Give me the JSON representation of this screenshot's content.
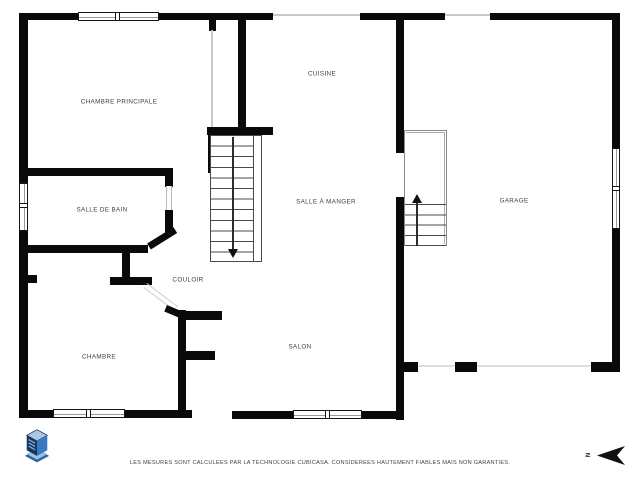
{
  "plan": {
    "type": "floor-plan",
    "rooms": [
      {
        "id": "chambre-principale",
        "label": "CHAMBRE PRINCIPALE"
      },
      {
        "id": "cuisine",
        "label": "CUISINE"
      },
      {
        "id": "salle-de-bain",
        "label": "SALLE DE BAIN"
      },
      {
        "id": "salle-a-manger",
        "label": "SALLE À MANGER"
      },
      {
        "id": "garage",
        "label": "GARAGE"
      },
      {
        "id": "couloir",
        "label": "COULOIR"
      },
      {
        "id": "chambre",
        "label": "CHAMBRE"
      },
      {
        "id": "salon",
        "label": "SALON"
      }
    ],
    "stairs": [
      {
        "id": "main-staircase",
        "direction_arrow": "down"
      },
      {
        "id": "garage-staircase",
        "direction_arrow": "up"
      }
    ],
    "window_count": 5
  },
  "footer": {
    "disclaimer": "LES MESURES SONT CALCULEES PAR LA TECHNOLOGIE CUBICASA. CONSIDEREES HAUTEMENT FIABLES MAIS NON GARANTIES."
  },
  "compass": {
    "north_label": "N",
    "arrow_points": "left"
  },
  "branding": {
    "logo": "cubicasa-3d-cube-logo"
  },
  "colors": {
    "wall": "#0a0a0a",
    "background": "#ffffff",
    "label_text": "#3f3f3f",
    "thin_line": "#c9c9c9",
    "logo_dark": "#16365c",
    "logo_mid": "#3a78c2",
    "logo_light": "#aac8e4"
  }
}
